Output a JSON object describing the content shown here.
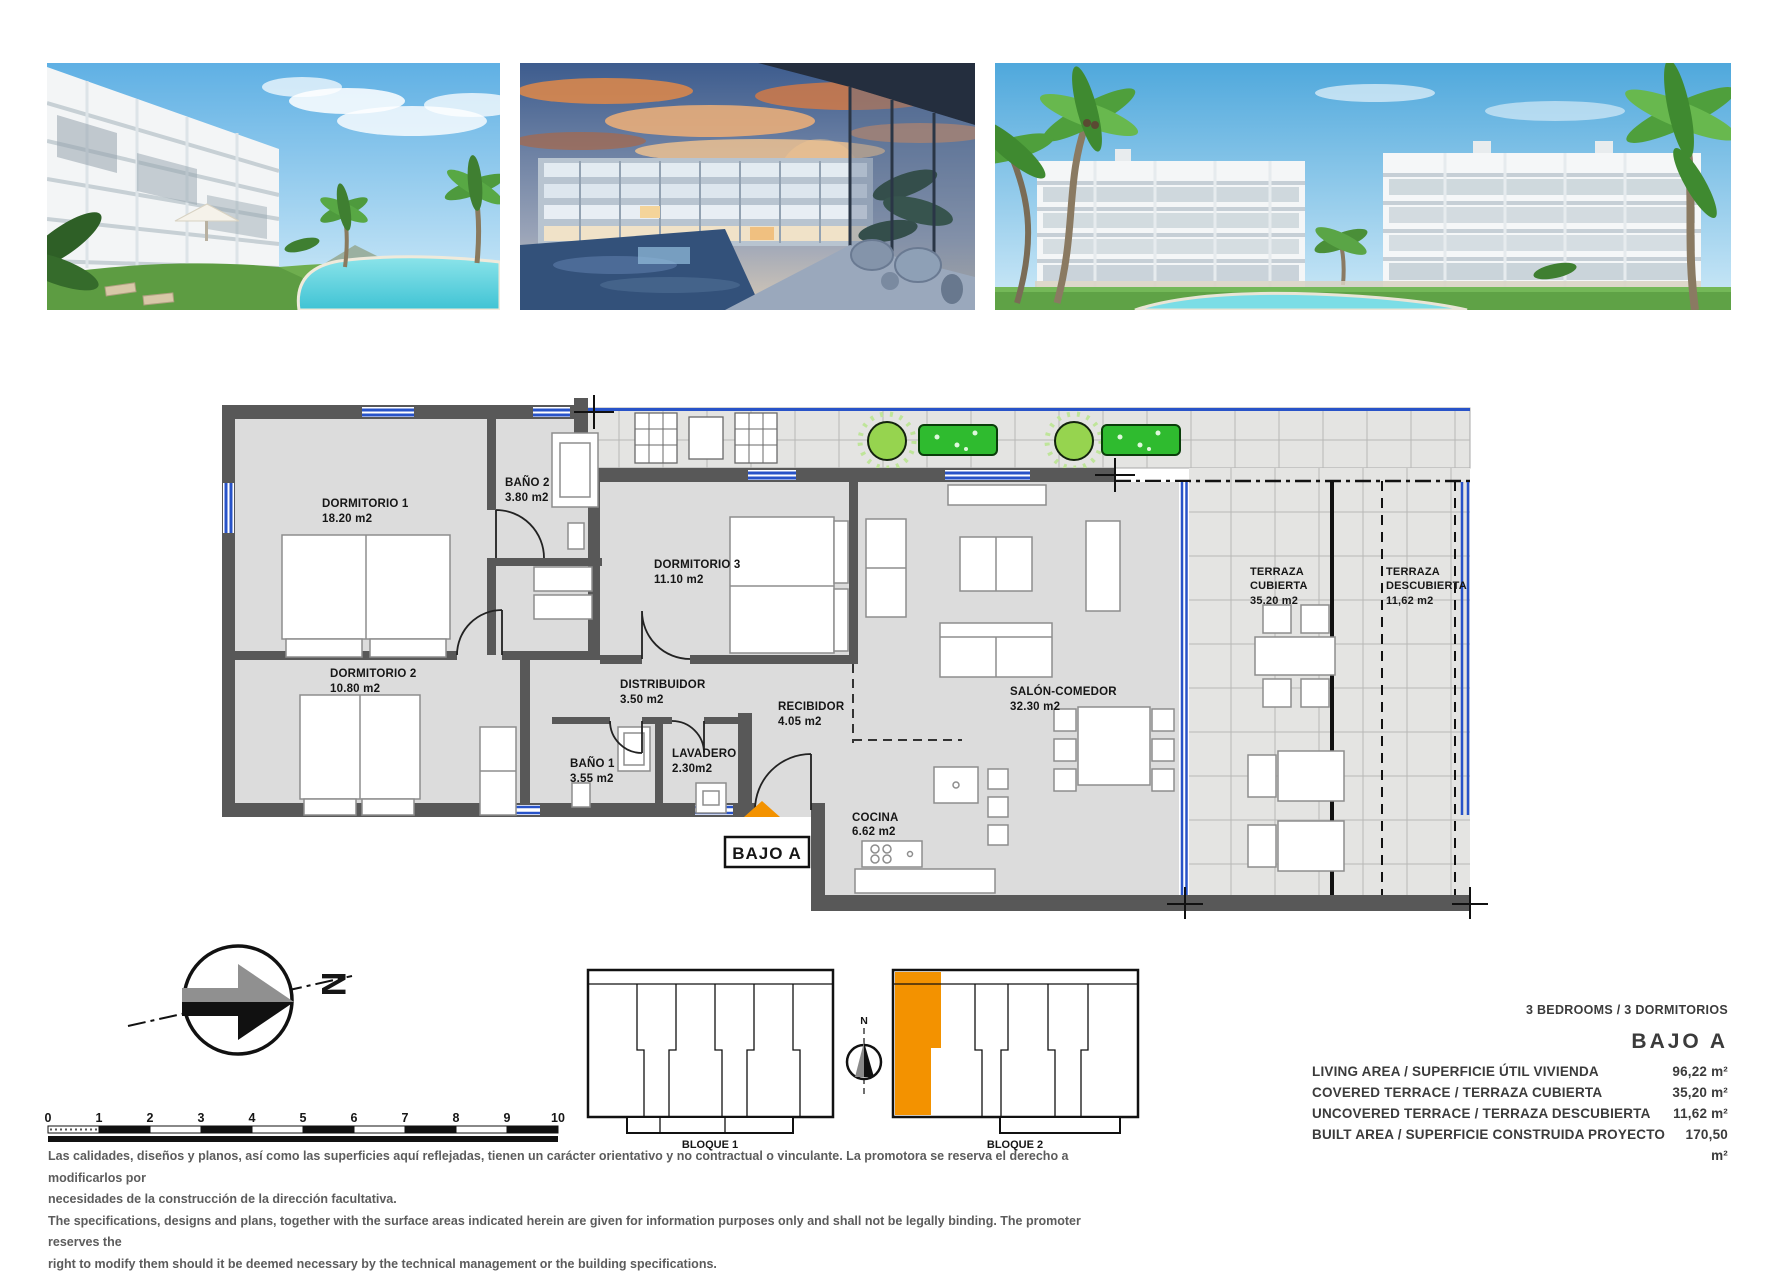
{
  "plan": {
    "unit_label": "BAJO A",
    "colors": {
      "accent_orange": "#F39200",
      "window_blue": "#2853C8",
      "plant_green": "#2FBB2F",
      "wall_gray": "#585858"
    },
    "rooms": [
      {
        "name": "DORMITORIO 1",
        "area": "18.20 m2"
      },
      {
        "name": "BAÑO 2",
        "area": "3.80 m2"
      },
      {
        "name": "DORMITORIO 3",
        "area": "11.10 m2"
      },
      {
        "name": "DORMITORIO 2",
        "area": "10.80 m2"
      },
      {
        "name": "DISTRIBUIDOR",
        "area": "3.50 m2"
      },
      {
        "name": "RECIBIDOR",
        "area": "4.05 m2"
      },
      {
        "name": "BAÑO 1",
        "area": "3.55 m2"
      },
      {
        "name": "LAVADERO",
        "area": "2.30m2"
      },
      {
        "name": "COCINA",
        "area": "6.62 m2"
      },
      {
        "name": "SALÓN-COMEDOR",
        "area": "32.30 m2"
      },
      {
        "name": "TERRAZA",
        "name2": "CUBIERTA",
        "area": "35.20 m2"
      },
      {
        "name": "TERRAZA",
        "name2": "DESCUBIERTA",
        "area": "11,62 m2"
      }
    ]
  },
  "compass": {
    "north": "N"
  },
  "scale": {
    "ticks": [
      "0",
      "1",
      "2",
      "3",
      "4",
      "5",
      "6",
      "7",
      "8",
      "9",
      "10"
    ]
  },
  "blocks": {
    "block1": "BLOQUE 1",
    "block2": "BLOQUE 2"
  },
  "specs": {
    "bedrooms_line": "3 BEDROOMS / 3 DORMITORIOS",
    "unit": "BAJO A",
    "rows": [
      {
        "label": "LIVING AREA / SUPERFICIE ÚTIL VIVIENDA",
        "value": "96,22 m²"
      },
      {
        "label": "COVERED TERRACE / TERRAZA CUBIERTA",
        "value": "35,20 m²"
      },
      {
        "label": "UNCOVERED TERRACE / TERRAZA DESCUBIERTA",
        "value": "11,62 m²"
      },
      {
        "label": "BUILT AREA / SUPERFICIE CONSTRUIDA PROYECTO",
        "value": "170,50 m²"
      }
    ]
  },
  "disclaimer": {
    "es1": "Las calidades, diseños y planos, así como las superficies aquí reflejadas, tienen un carácter orientativo y no contractual o vinculante. La promotora se reserva el derecho a modificarlos por",
    "es2": "necesidades de la construcción de la dirección facultativa.",
    "en1": "The specifications, designs and plans, together with the surface areas indicated herein are given for information purposes only and shall not be legally binding. The promoter reserves the",
    "en2": "right to modify them should it be deemed necessary by the technical management or the building specifications."
  }
}
